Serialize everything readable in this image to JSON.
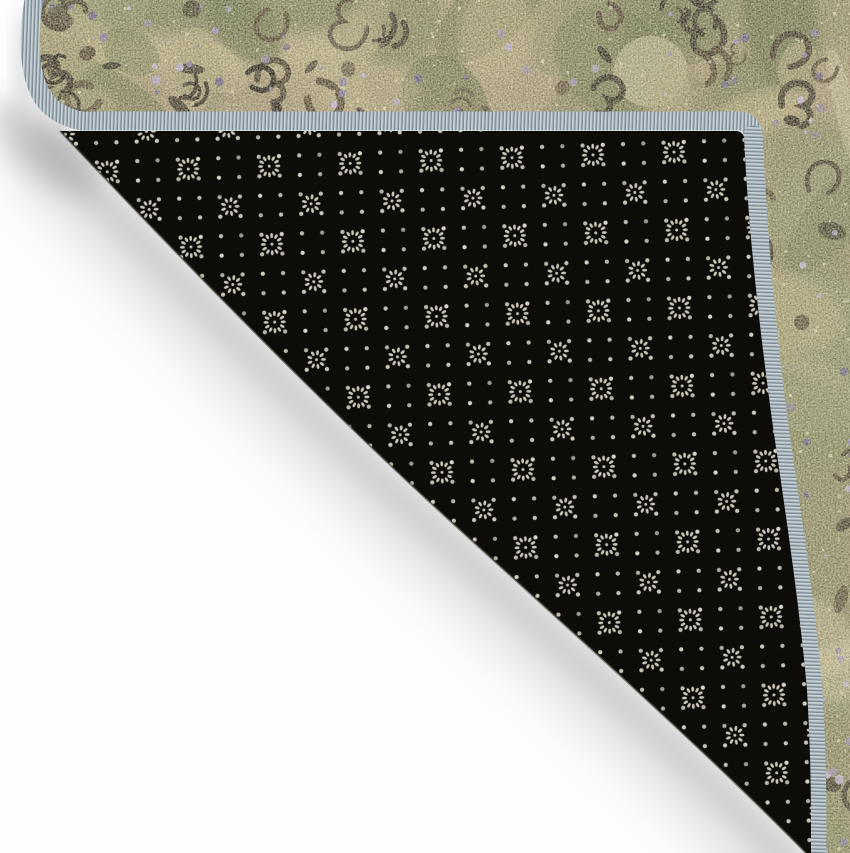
{
  "scene": {
    "description": "Product photo of a vintage-style area rug with its corner folded over, revealing a black non-slip dotted backing and a gray serged edge binding on a white background",
    "colors": {
      "floor": "#fdfdfd",
      "shadow_inner": "#a8a8a8",
      "shadow_outer": "#c9c9c9",
      "shadow_corner": "#9f9f9f",
      "shadow_sliver": "#cfcfcf",
      "face_base": "#b7a67a",
      "backing_base": "#0d0c09",
      "backing_dot": "#d9d4c6",
      "binding_base": "#9cabb3",
      "binding_light": "#c9d2d6",
      "binding_dark": "#707f88",
      "edge_highlight": "#46453b"
    },
    "face_palette": {
      "greens": [
        "#76814b",
        "#8a9158",
        "#64713e",
        "#97a06b"
      ],
      "pales": [
        "#d5ca92",
        "#cbbf85",
        "#e0d8a6",
        "#c2b67f"
      ],
      "darks": [
        "#2b2316",
        "#3c3120",
        "#1d180e",
        "#4a3d26"
      ],
      "purples": [
        "#9083a8",
        "#7a6c93",
        "#a99bc1",
        "#635678",
        "#b3a8c9"
      ],
      "speckle": "#e0d8ae"
    },
    "backing_pattern": {
      "dot_spacing_x": 20.25,
      "dot_spacing_y": 19.5,
      "cell_w": 81,
      "cell_h": 78,
      "dot_radius": 2.15,
      "flower_a_petals": 12,
      "flower_a_radius": 8.6,
      "flower_b_petals": 9,
      "flower_b_radius": 7,
      "tilt_deg": -2
    }
  }
}
